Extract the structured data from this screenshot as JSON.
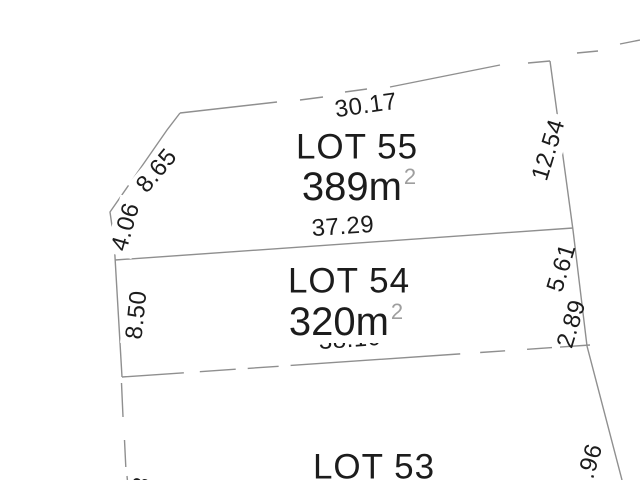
{
  "drawing_title": "",
  "lots": [
    {
      "name": "LOT 55",
      "area": "389m",
      "area_exponent": "2"
    },
    {
      "name": "LOT 54",
      "area": "320m",
      "area_exponent": "2"
    },
    {
      "name": "LOT 53"
    }
  ],
  "dimensions": {
    "top_edge": "30.17",
    "lot55_east_edge": "12.54",
    "lot55_lot54_edge": "37.29",
    "west_edge_upper": "8.65",
    "west_edge_mid": "4.06",
    "lot54_west_edge": "8.50",
    "east_edge_upper": "5.61",
    "east_edge_lower": "2.89",
    "lot54_lot53_edge": "38.10",
    "east_edge_bottom_partial": "1.96",
    "west_edge_bottom_partial": "3"
  },
  "colors": {
    "background": "#ffffff",
    "text": "#1c1c1c",
    "boundary_line": "#8f8f8f",
    "area_superscript": "#9e9e9e"
  }
}
